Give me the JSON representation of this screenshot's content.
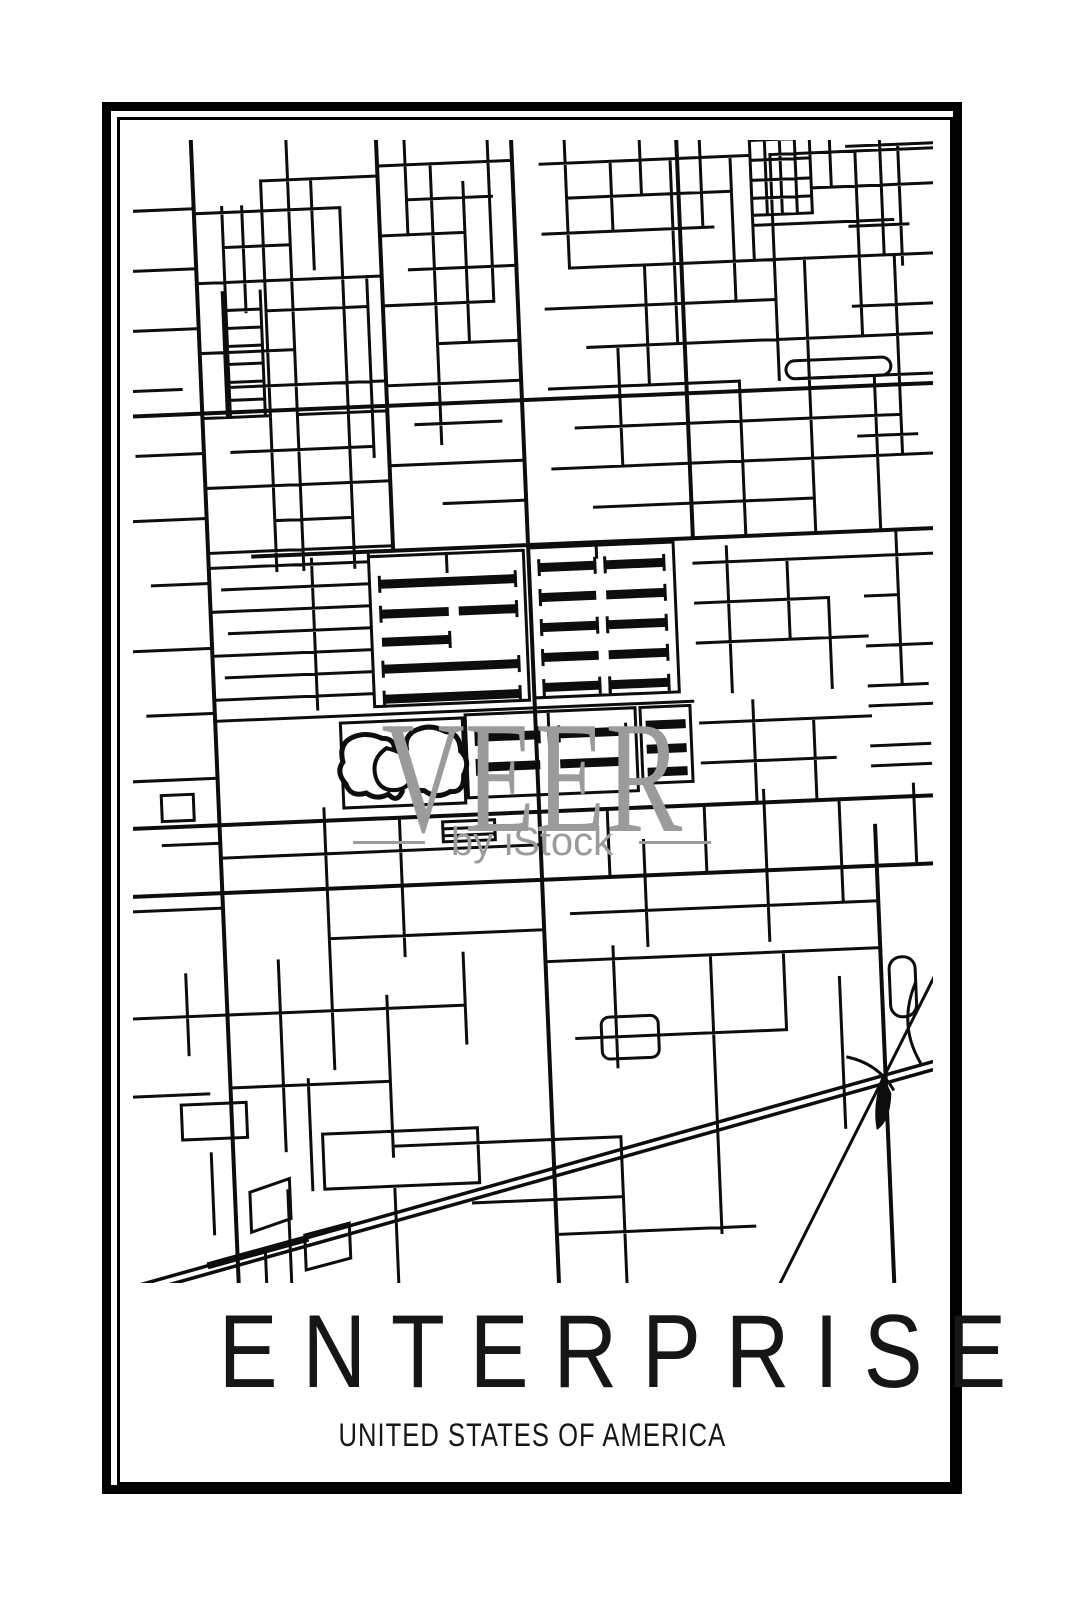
{
  "poster": {
    "title": "ENTERPRISE",
    "subtitle": "UNITED STATES OF AMERICA"
  },
  "watermark": {
    "brand": "VEER",
    "byline": "by iStock"
  },
  "colors": {
    "background": "#ffffff",
    "frame": "#000000",
    "street": "#0d0d0d",
    "watermark_gray": "#9b9b9b"
  }
}
